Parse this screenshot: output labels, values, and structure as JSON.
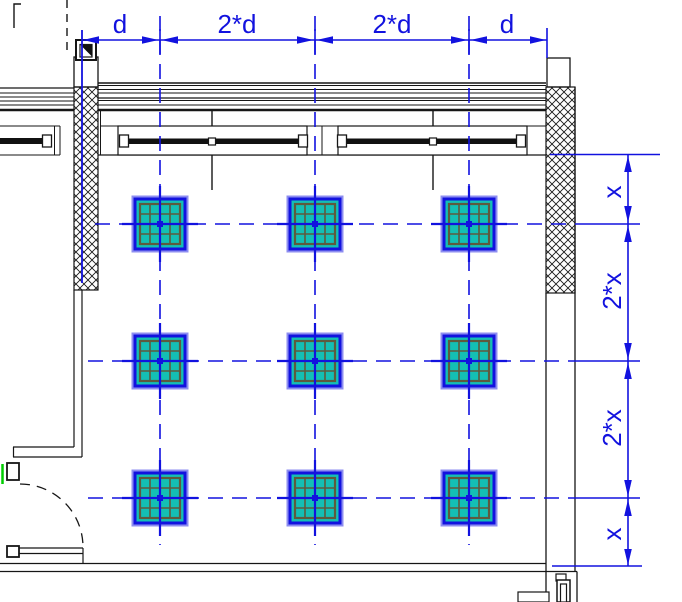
{
  "title": "Column grid floor plan with dimension axes",
  "dims": {
    "top": [
      "d",
      "2*d",
      "2*d",
      "d"
    ],
    "right": [
      "x",
      "2*x",
      "2*x",
      "x"
    ]
  },
  "grid": {
    "column_rows": 3,
    "column_cols": 3,
    "column_cell_pattern": "4x4",
    "horizontal_spacing_pattern": "d, 2*d, 2*d, d",
    "vertical_spacing_pattern": "x, 2*x, 2*x, x"
  },
  "plan": {
    "column_axes_x": [
      160,
      315,
      469
    ],
    "row_axes_y": [
      224,
      361,
      498
    ]
  },
  "colors": {
    "axis_blue": "#1212df",
    "column_fill_teal": "#14bfb4",
    "column_grid_olive": "#5e5a3e",
    "wall_black": "#161616",
    "door_accent_green": "#00cc00"
  }
}
